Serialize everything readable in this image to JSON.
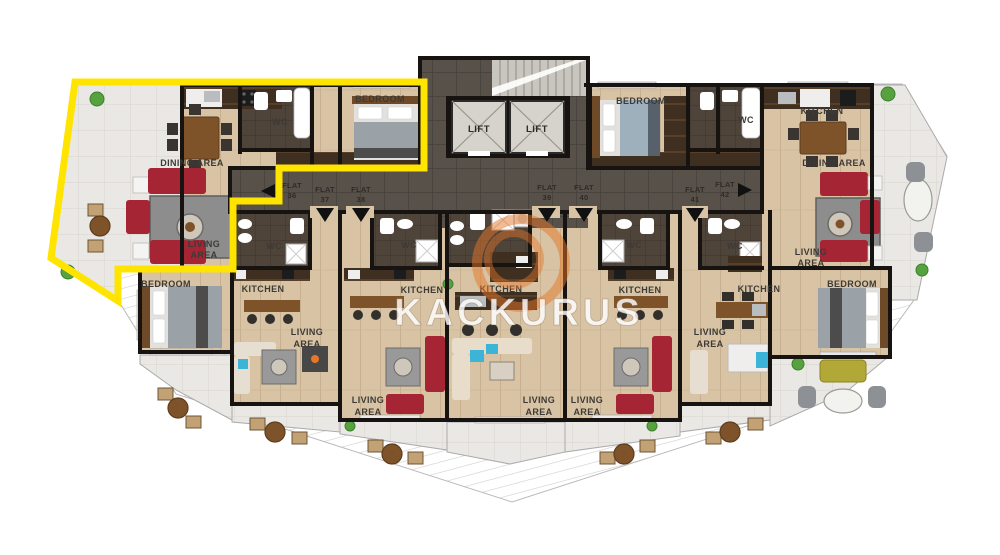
{
  "watermark": {
    "brand": "KACKURUS"
  },
  "core": {
    "lift_left": "LIFT",
    "lift_right": "LIFT"
  },
  "corridor": {
    "flat_word": "FLAT",
    "flats": [
      {
        "number": "36",
        "arrow": "left"
      },
      {
        "number": "37",
        "arrow": "down"
      },
      {
        "number": "38",
        "arrow": "down"
      },
      {
        "number": "39",
        "arrow": "down"
      },
      {
        "number": "40",
        "arrow": "down"
      },
      {
        "number": "41",
        "arrow": "down"
      },
      {
        "number": "42",
        "arrow": "right"
      }
    ]
  },
  "room_labels": {
    "dining": "DINING AREA",
    "living_line1": "LIVING",
    "living_line2": "AREA",
    "kitchen": "KITCHEN",
    "bedroom": "BEDROOM",
    "wc": "WC"
  },
  "colors": {
    "highlight_outline": "#ffe400",
    "sofa_red": "#a62534",
    "logo_orange": "#e7762a",
    "balcony_sofa_olive": "#b2a838",
    "accent_teal": "#3cb4d8"
  }
}
